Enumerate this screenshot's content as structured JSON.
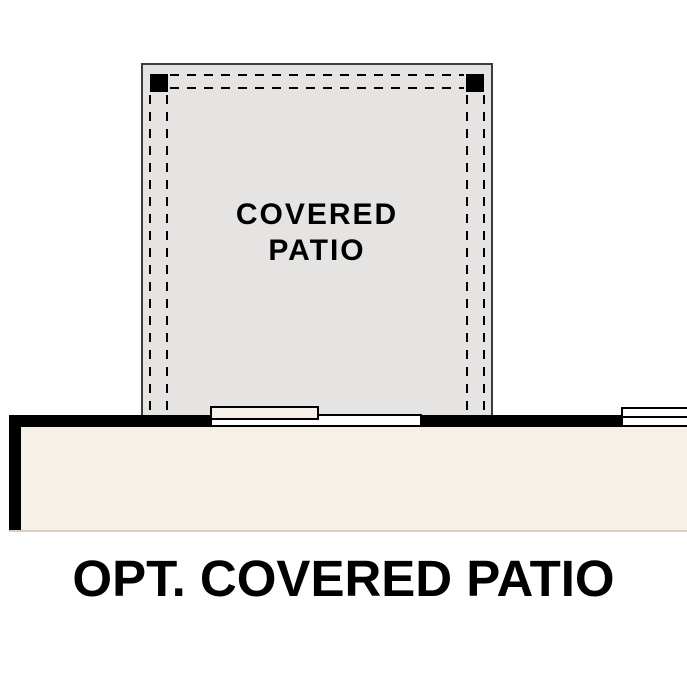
{
  "plan": {
    "patio_label": "COVERED PATIO",
    "caption": "OPT. COVERED PATIO"
  },
  "colors": {
    "background": "#ffffff",
    "patio-fill": "#e5e4e2",
    "interior-fill": "#f7f0e6",
    "outline": "#3d3d3d",
    "wall": "#000000",
    "opening-fill": "#ffffff",
    "text": "#000000"
  }
}
